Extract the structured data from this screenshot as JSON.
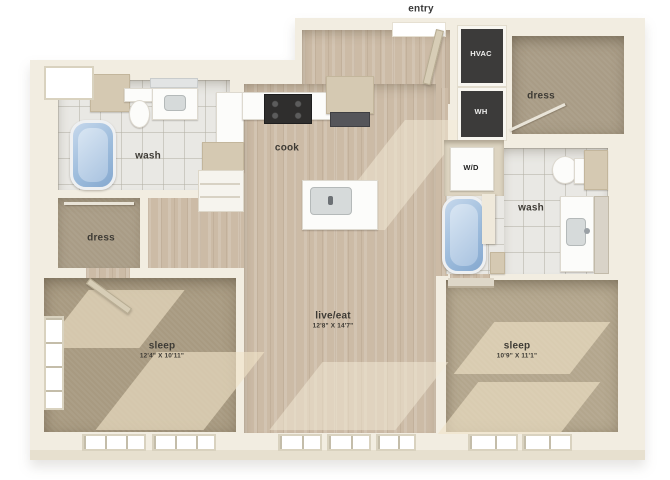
{
  "plan": {
    "entry": {
      "label": "entry"
    },
    "hvac": {
      "label": "HVAC"
    },
    "wh": {
      "label": "WH"
    },
    "dress_top": {
      "label": "dress"
    },
    "wash_left": {
      "label": "wash"
    },
    "cook": {
      "label": "cook"
    },
    "wd": {
      "label": "W/D"
    },
    "wash_right": {
      "label": "wash"
    },
    "dress_left": {
      "label": "dress"
    },
    "live_eat": {
      "label": "live/eat",
      "dims": "12'8\" X 14'7\""
    },
    "sleep_left": {
      "label": "sleep",
      "dims": "12'4\" X 10'11\""
    },
    "sleep_right": {
      "label": "sleep",
      "dims": "10'9\" X 11'1\""
    }
  },
  "colors": {
    "wall": "#f2ede1",
    "wood_floor": "#ccbba6",
    "carpet": "#ab9d85",
    "tile": "#e9e8e4",
    "utility_closet": "#3c3b3a",
    "tub_blue": "#9dbcdc"
  }
}
